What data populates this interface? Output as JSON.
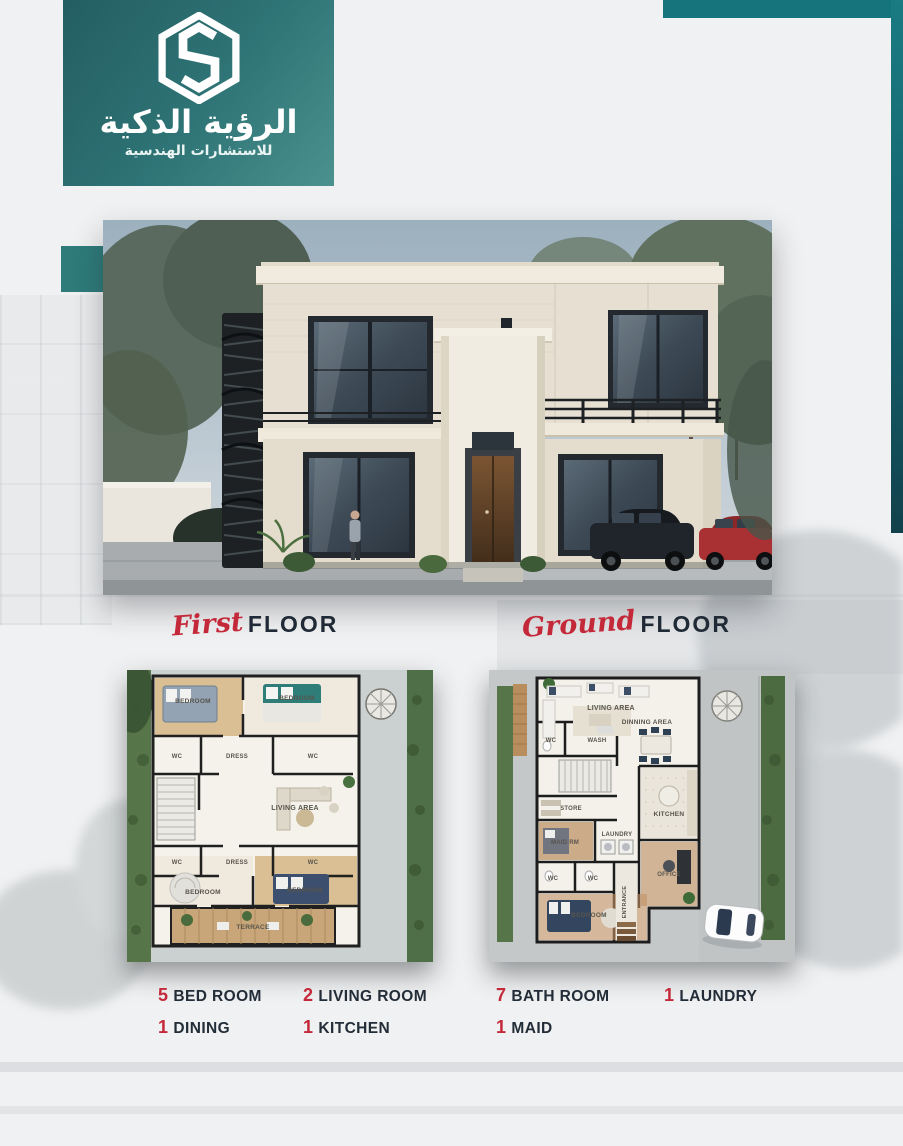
{
  "logo": {
    "monogram": "S",
    "title_ar": "الرؤية الذكية",
    "subtitle_ar": "للاستشارات الهندسية"
  },
  "colors": {
    "teal": "#2e7375",
    "teal_dark": "#11414c",
    "accent_red": "#c4293a",
    "navy": "#1f2a36",
    "page_bg": "#f0f1f2"
  },
  "sections": {
    "first_floor": {
      "script": "First",
      "word": "FLOOR"
    },
    "ground_floor": {
      "script": "Ground",
      "word": "FLOOR"
    }
  },
  "plans": {
    "first": {
      "rooms": [
        "BEDROOM",
        "BEDROOM",
        "WC",
        "DRESS",
        "WC",
        "LIVING AREA",
        "WC",
        "DRESS",
        "WC",
        "BEDROOM",
        "BEDROOM",
        "TERRACE"
      ]
    },
    "ground": {
      "rooms": [
        "LIVING AREA",
        "DINNING AREA",
        "WC",
        "WASH",
        "STORE",
        "MAID RM",
        "LAUNDRY",
        "KITCHEN",
        "WC",
        "WC",
        "OFFICE",
        "ENTRANCE",
        "BEDROOM"
      ]
    }
  },
  "stats": {
    "row1": [
      {
        "num": "5",
        "label": "BED ROOM"
      },
      {
        "num": "2",
        "label": "LIVING ROOM"
      },
      {
        "num": "7",
        "label": "BATH ROOM"
      },
      {
        "num": "1",
        "label": "LAUNDRY"
      }
    ],
    "row2": [
      {
        "num": "1",
        "label": "DINING"
      },
      {
        "num": "1",
        "label": "KITCHEN"
      },
      {
        "num": "1",
        "label": "MAID"
      }
    ]
  }
}
